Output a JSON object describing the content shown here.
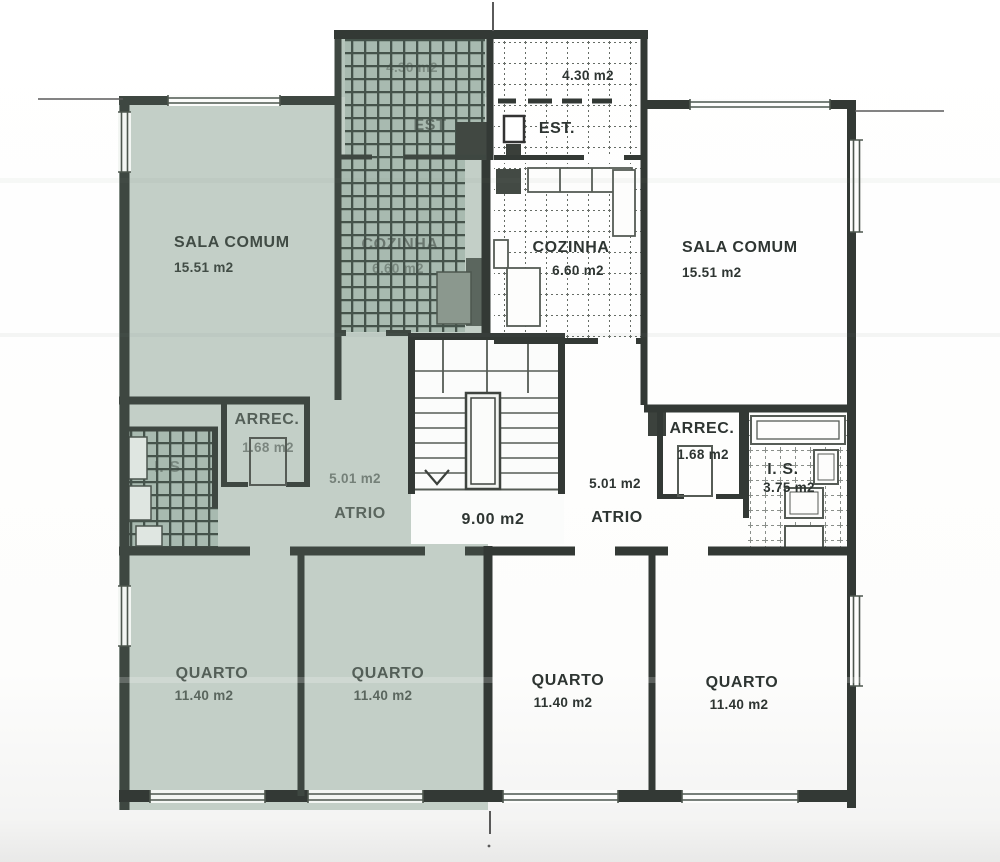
{
  "plan": {
    "tint_color": "#c3cfc7",
    "units": {
      "left": {
        "highlighted": true,
        "rooms": {
          "est": {
            "label": "EST",
            "area": "4.30 m2"
          },
          "sala": {
            "label": "SALA COMUM",
            "area": "15.51 m2"
          },
          "cozinha": {
            "label": "COZINHA",
            "area": "6.60 m2"
          },
          "arrec": {
            "label": "ARREC.",
            "area": "1.68 m2"
          },
          "is": {
            "label": "I. S."
          },
          "atrio": {
            "label": "ATRIO",
            "area": "5.01 m2"
          },
          "quarto_1": {
            "label": "QUARTO",
            "area": "11.40 m2"
          },
          "quarto_2": {
            "label": "QUARTO",
            "area": "11.40 m2"
          }
        }
      },
      "right": {
        "highlighted": false,
        "rooms": {
          "est": {
            "label": "EST.",
            "area": "4.30 m2"
          },
          "sala": {
            "label": "SALA COMUM",
            "area": "15.51 m2"
          },
          "cozinha": {
            "label": "COZINHA",
            "area": "6.60 m2"
          },
          "arrec": {
            "label": "ARREC.",
            "area": "1.68 m2"
          },
          "is": {
            "label": "I. S.",
            "area": "3.75 m2"
          },
          "atrio": {
            "label": "ATRIO",
            "area": "5.01 m2"
          },
          "quarto_3": {
            "label": "QUARTO",
            "area": "11.40 m2"
          },
          "quarto_4": {
            "label": "QUARTO",
            "area": "11.40 m2"
          }
        }
      }
    },
    "common": {
      "stairwell": {
        "area": "9.00 m2"
      }
    }
  }
}
